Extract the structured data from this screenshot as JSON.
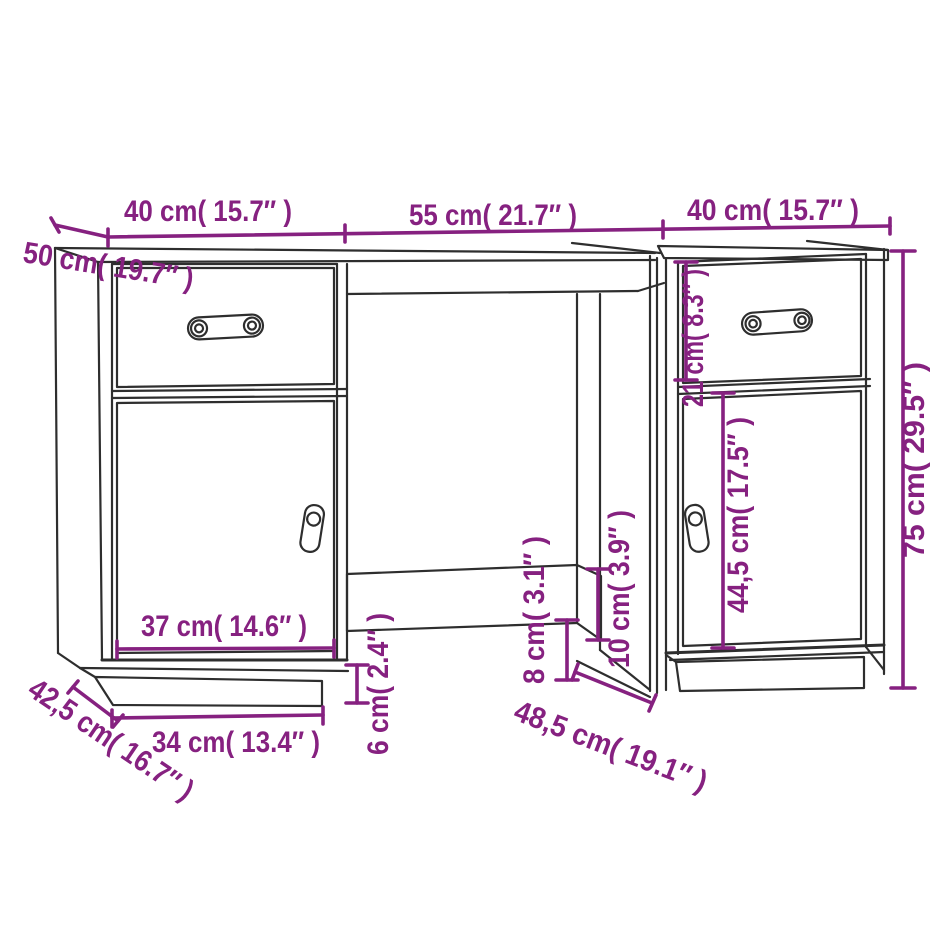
{
  "diagram": {
    "type": "furniture-dimension-diagram",
    "subject": "desk with two pedestal cabinets (drawer + door each), kneehole and modesty rail",
    "background": "#ffffff",
    "outline_color": "#2e2e2e",
    "dimension_color": "#862180"
  },
  "dimensions": {
    "top_left_width": {
      "label": "40 cm( 15.7″ )",
      "meaning": "left section width"
    },
    "top_center_width": {
      "label": "55 cm( 21.7″ )",
      "meaning": "center section width"
    },
    "top_right_width": {
      "label": "40 cm( 15.7″ )",
      "meaning": "right cabinet width"
    },
    "desk_depth": {
      "label": "50 cm( 19.7″ )",
      "meaning": "desktop depth"
    },
    "right_drawer_height": {
      "label": "21 cm( 8.3″ )",
      "meaning": "drawer front height"
    },
    "right_door_height": {
      "label": "44,5 cm( 17.5″ )",
      "meaning": "door height"
    },
    "total_height": {
      "label": "75 cm( 29.5″ )",
      "meaning": "overall height"
    },
    "left_door_width": {
      "label": "37 cm( 14.6″ )",
      "meaning": "door width"
    },
    "plinth_width": {
      "label": "34 cm( 13.4″ )",
      "meaning": "plinth width"
    },
    "plinth_depth": {
      "label": "42,5 cm( 16.7″ )",
      "meaning": "plinth depth"
    },
    "plinth_height": {
      "label": "6 cm( 2.4″ )",
      "meaning": "plinth height"
    },
    "rail_floor_gap": {
      "label": "8 cm( 3.1″ )",
      "meaning": "rail to floor gap"
    },
    "rail_height": {
      "label": "10 cm( 3.9″ )",
      "meaning": "modesty rail height"
    },
    "kneehole_depth": {
      "label": "48,5 cm( 19.1″ )",
      "meaning": "kneehole depth"
    }
  }
}
